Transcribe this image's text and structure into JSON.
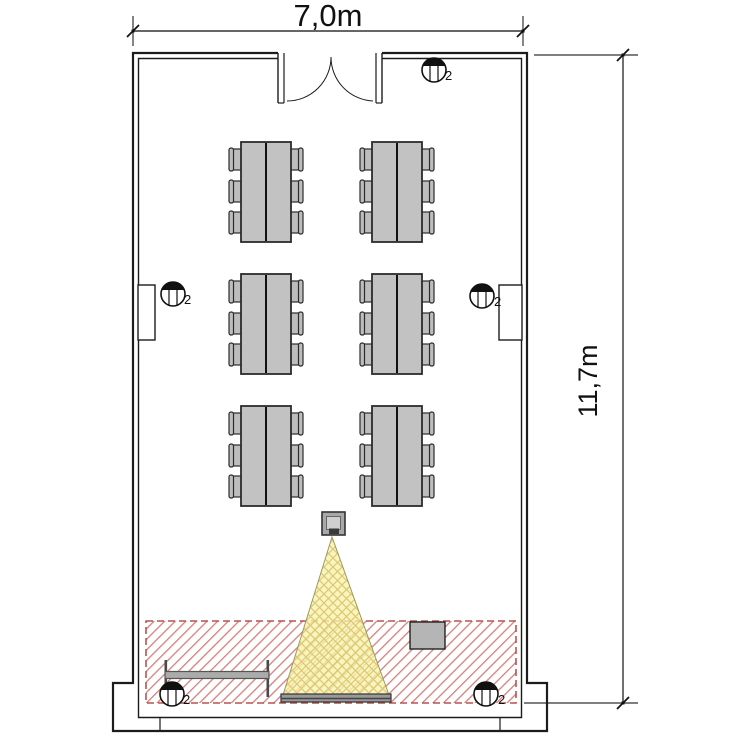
{
  "plan": {
    "type": "classroom-floor-plan",
    "width_label": "7,0m",
    "height_label": "11,7m",
    "light_label": "2",
    "counts": {
      "table_groups": 6,
      "chairs_per_group": 6,
      "wall_lights": 5
    },
    "colors": {
      "hatch_red": "#c9706d",
      "hatch_border": "#b85450",
      "beam_yellow": "#f8f2ad",
      "beam_hatch": "#dcc36a",
      "furniture_gray": "#c2c2c2",
      "wall": "#1c1c1c"
    }
  }
}
